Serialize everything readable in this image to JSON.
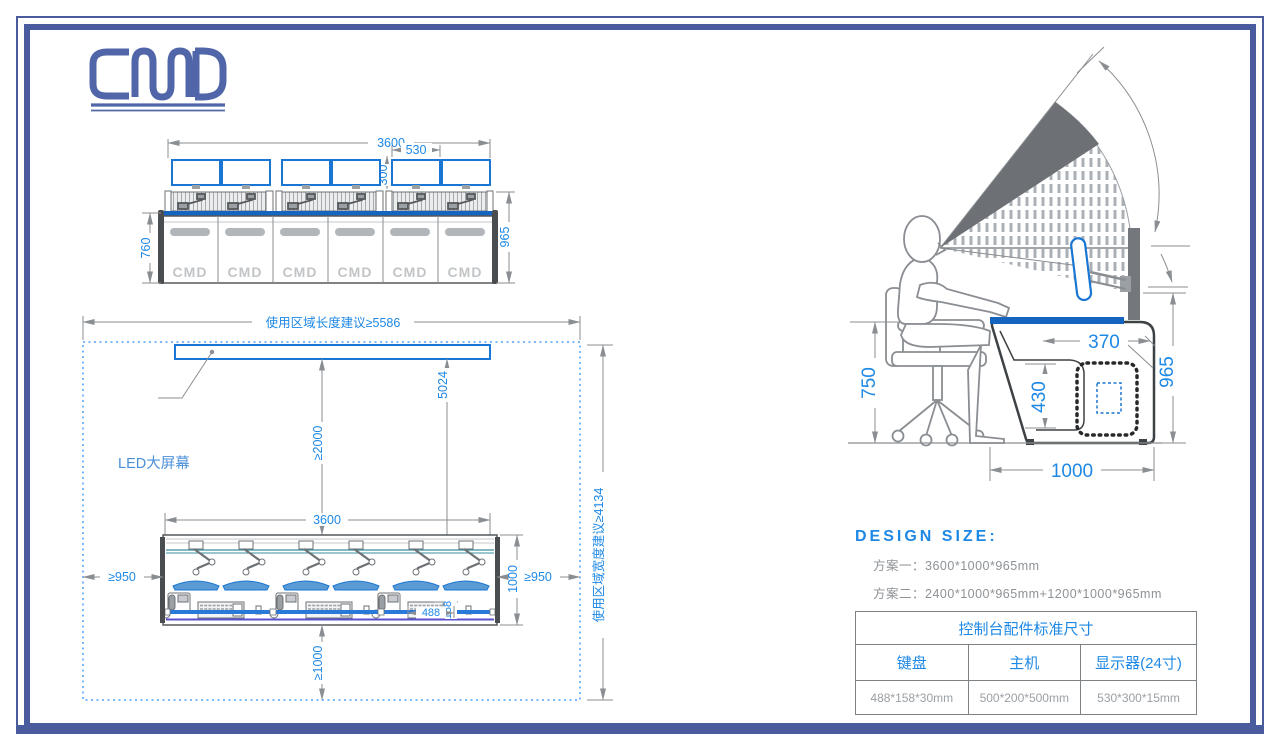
{
  "logo": {
    "text": "CMD"
  },
  "front_view": {
    "panel_logo": "CMD",
    "dims": {
      "total_width": "3600",
      "monitor_width": "530",
      "monitor_height": "300",
      "body_height": "760",
      "total_height": "965"
    }
  },
  "plan_view": {
    "labels": {
      "area_length": "使用区域长度建议≥5586",
      "area_width": "使用区域宽度建议≥4134",
      "led_screen": "LED大屏幕"
    },
    "dims": {
      "screen_clearance": "≥2000",
      "screen_to_front": "5024",
      "console_width": "3600",
      "left_clearance": "≥950",
      "right_clearance": "≥950",
      "console_depth": "1000",
      "keyboard_width": "488",
      "keyboard_depth": "158",
      "front_clearance": "≥1000"
    }
  },
  "side_view": {
    "dims": {
      "armrest_height": "750",
      "monitor_setback": "370",
      "compartment_height": "430",
      "console_height": "965",
      "console_depth": "1000"
    }
  },
  "design_size": {
    "title": "DESIGN SIZE:",
    "options": [
      {
        "label": "方案一：",
        "value": "3600*1000*965mm"
      },
      {
        "label": "方案二：",
        "value": "2400*1000*965mm+1200*1000*965mm"
      }
    ]
  },
  "spec_table": {
    "title": "控制台配件标准尺寸",
    "columns": [
      "键盘",
      "主机",
      "显示器(24寸)"
    ],
    "values": [
      "488*158*30mm",
      "500*200*500mm",
      "530*300*15mm"
    ]
  },
  "colors": {
    "frame_blue": "#4a5b9e",
    "dimension_blue": "#1e88e5",
    "desk_blue": "#1565c0",
    "line_gray": "#8a8e92"
  }
}
